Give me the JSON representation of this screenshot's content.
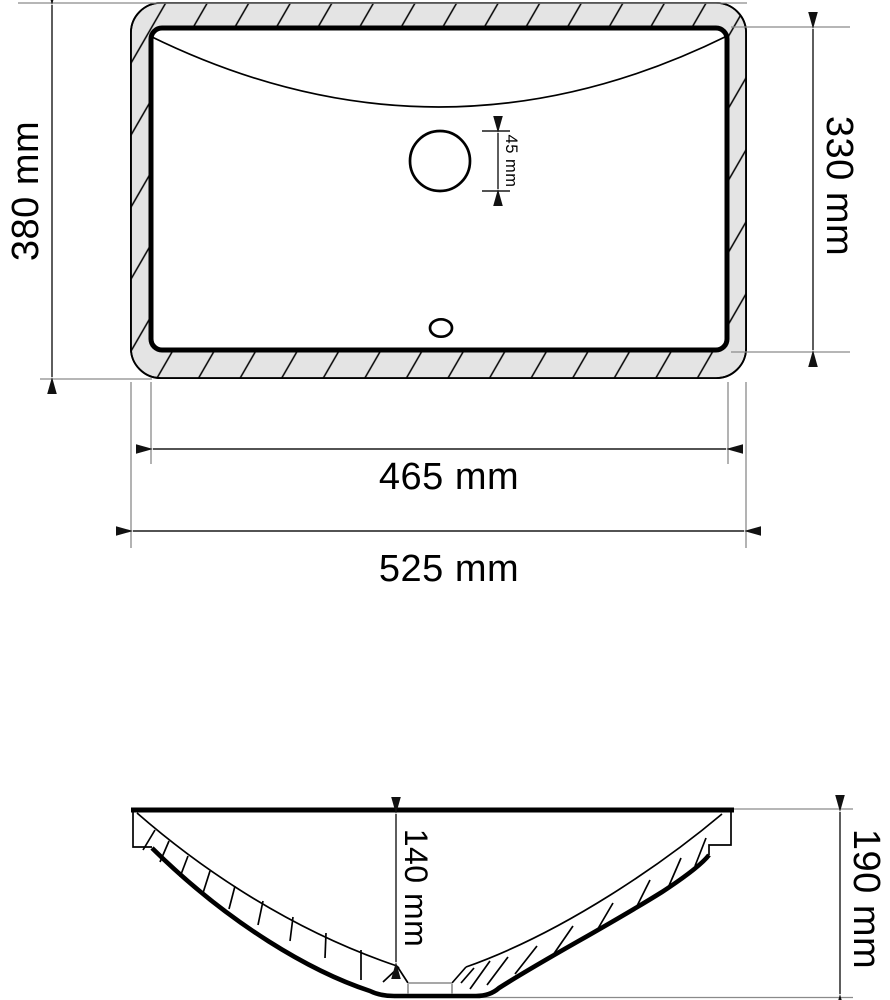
{
  "drawing": {
    "type": "technical dimension drawing",
    "subject": "rectangular undermount wash basin",
    "top_view": {
      "labels": {
        "outer_width": "525 mm",
        "inner_width": "465 mm",
        "outer_depth": "380 mm",
        "inner_depth": "330 mm",
        "drain_hole_diameter": "45 mm"
      },
      "features": [
        "ceramic-rim-hatched",
        "basin-opening",
        "drain-hole-circle",
        "overflow-hole"
      ]
    },
    "section_view": {
      "labels": {
        "bowl_depth": "140 mm",
        "total_height": "190 mm"
      },
      "features": [
        "bowl-cross-section",
        "drain-recess",
        "wall-hatching"
      ]
    },
    "colors": {
      "rim_fill": "#e4e4e4",
      "line": "#000000",
      "extension_line": "#8a8a8a"
    }
  }
}
